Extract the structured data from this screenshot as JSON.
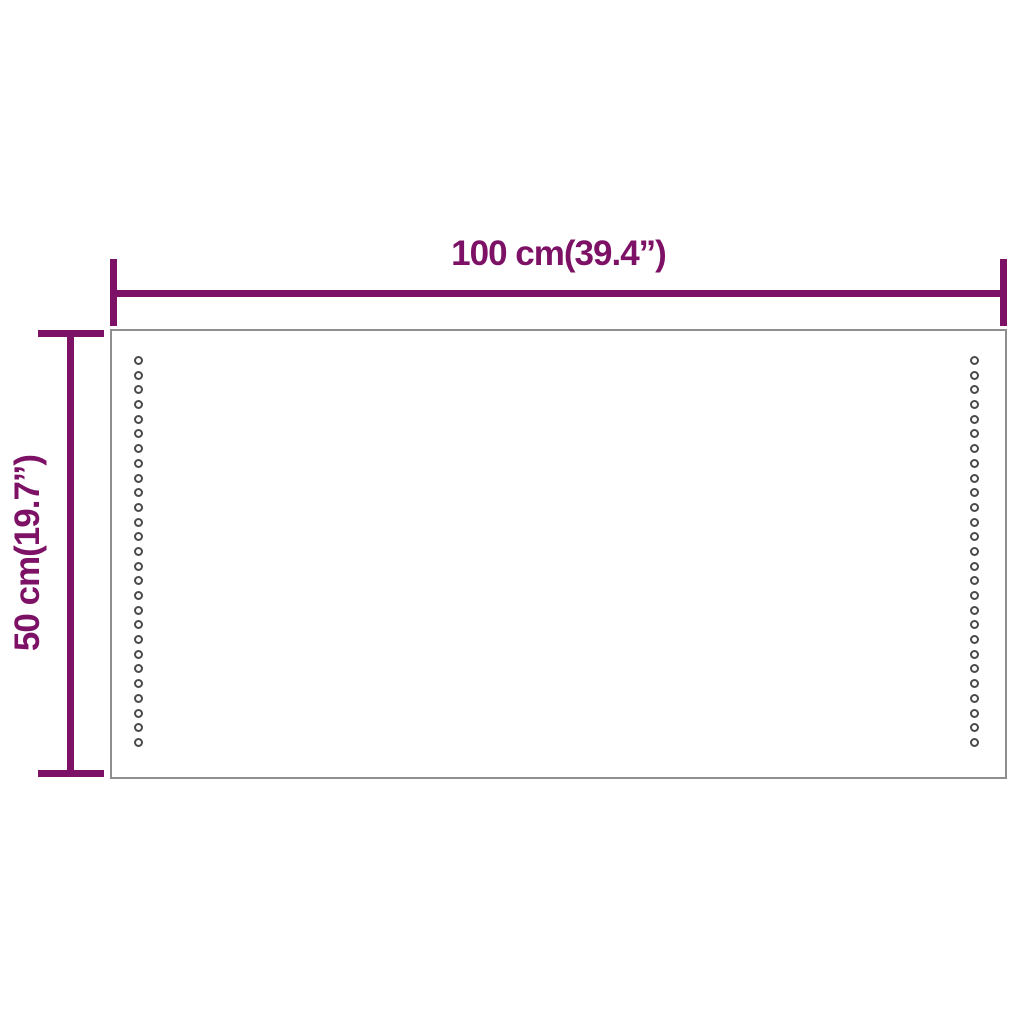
{
  "product_diagram": {
    "type": "dimension-diagram",
    "subject": "rectangular LED mirror panel",
    "width_dimension": {
      "label": "100 cm(39.4”)",
      "value_cm": 100,
      "value_in": 39.4
    },
    "height_dimension": {
      "label": "50 cm(19.7”)",
      "value_cm": 50,
      "value_in": 19.7
    },
    "led_dots": {
      "columns": 2,
      "per_column": 27
    },
    "colors": {
      "dimension": "#7C1166",
      "panel_border": "#8E8E8E",
      "dot": "#4A4A4A",
      "background": "#FFFFFF"
    }
  }
}
